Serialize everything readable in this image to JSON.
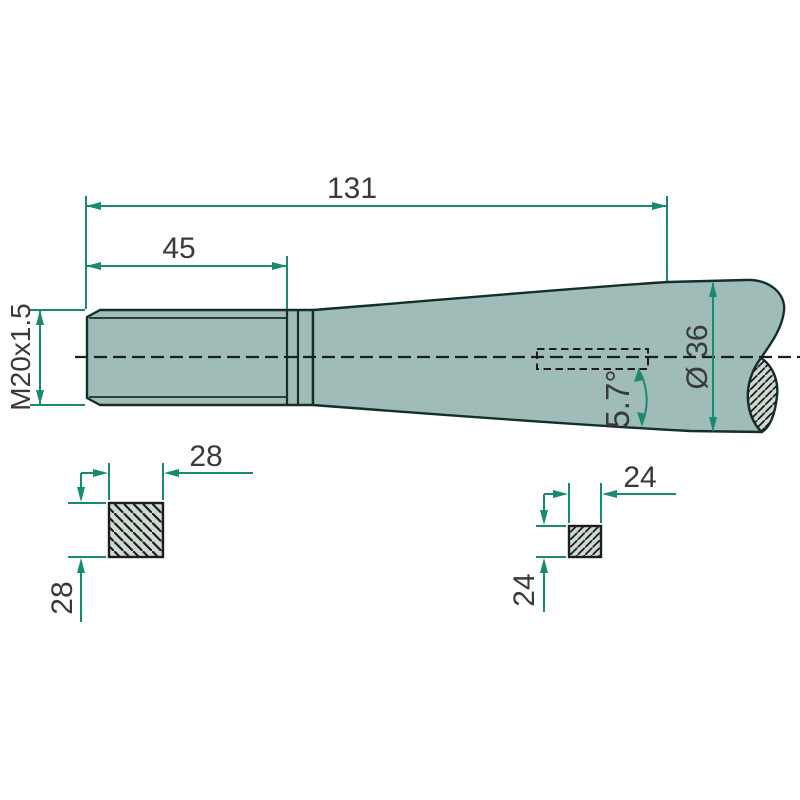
{
  "colors": {
    "dimension": "#178a6f",
    "outline": "#123029",
    "bodyFill": "#a0bcb8",
    "sectionFill": "#ced9d1",
    "ink": "#1d1d1d",
    "text": "#3a3a3a",
    "background": "#ffffff"
  },
  "labels": {
    "overall_length": "131",
    "thread_length": "45",
    "thread_spec": "M20x1.5",
    "shaft_diameter": "Ø 36",
    "taper_angle": "5.7°",
    "large_square_width": "28",
    "large_square_height": "28",
    "small_square_width": "24",
    "small_square_height": "24"
  }
}
